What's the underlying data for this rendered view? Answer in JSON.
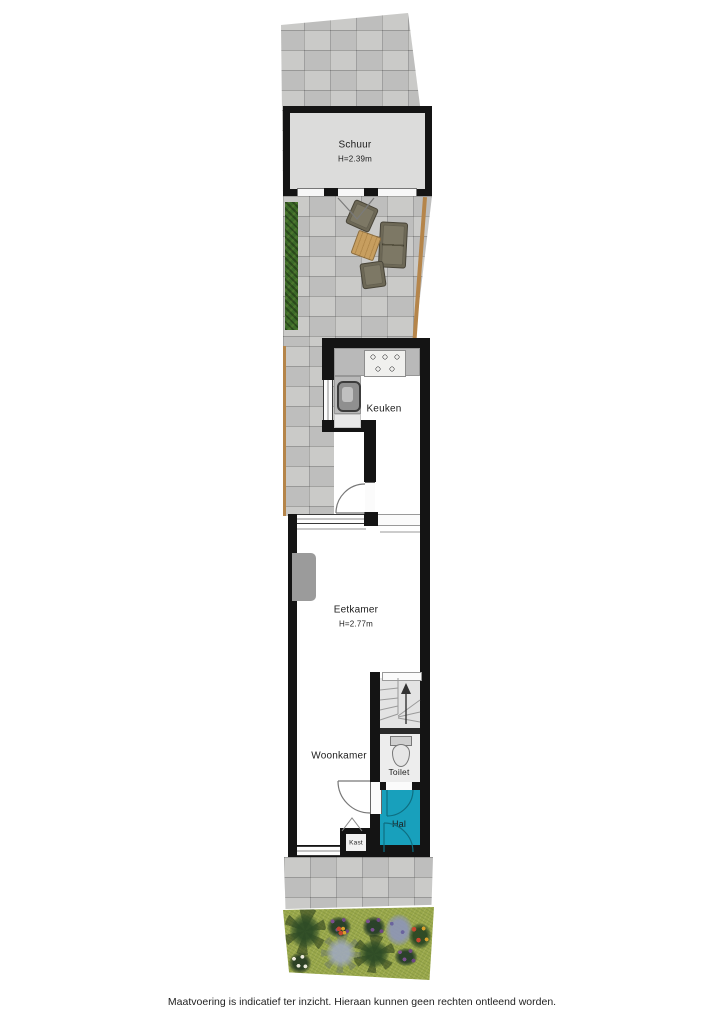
{
  "rooms": {
    "schuur": {
      "label": "Schuur",
      "height": "H=2.39m"
    },
    "keuken": {
      "label": "Keuken"
    },
    "eetkamer": {
      "label": "Eetkamer",
      "height": "H=2.77m"
    },
    "woonkamer": {
      "label": "Woonkamer"
    },
    "toilet": {
      "label": "Toilet"
    },
    "hal": {
      "label": "Hal"
    },
    "kast": {
      "label": "Kast"
    }
  },
  "footer": {
    "disclaimer": "Maatvoering is indicatief ter inzicht. Hieraan kunnen geen rechten ontleend worden."
  },
  "colors": {
    "wall": "#141414",
    "hal_floor": "#18a0bc",
    "pavement": "#c7c7c5",
    "shed_floor": "#dcdcdb",
    "hedge": "#3c6a28",
    "grass": "#9aa84b",
    "fence": "#b5854a",
    "counter": "#b9b9b9",
    "stairs_floor": "#e3e3e3",
    "toilet_floor": "#ededed"
  }
}
